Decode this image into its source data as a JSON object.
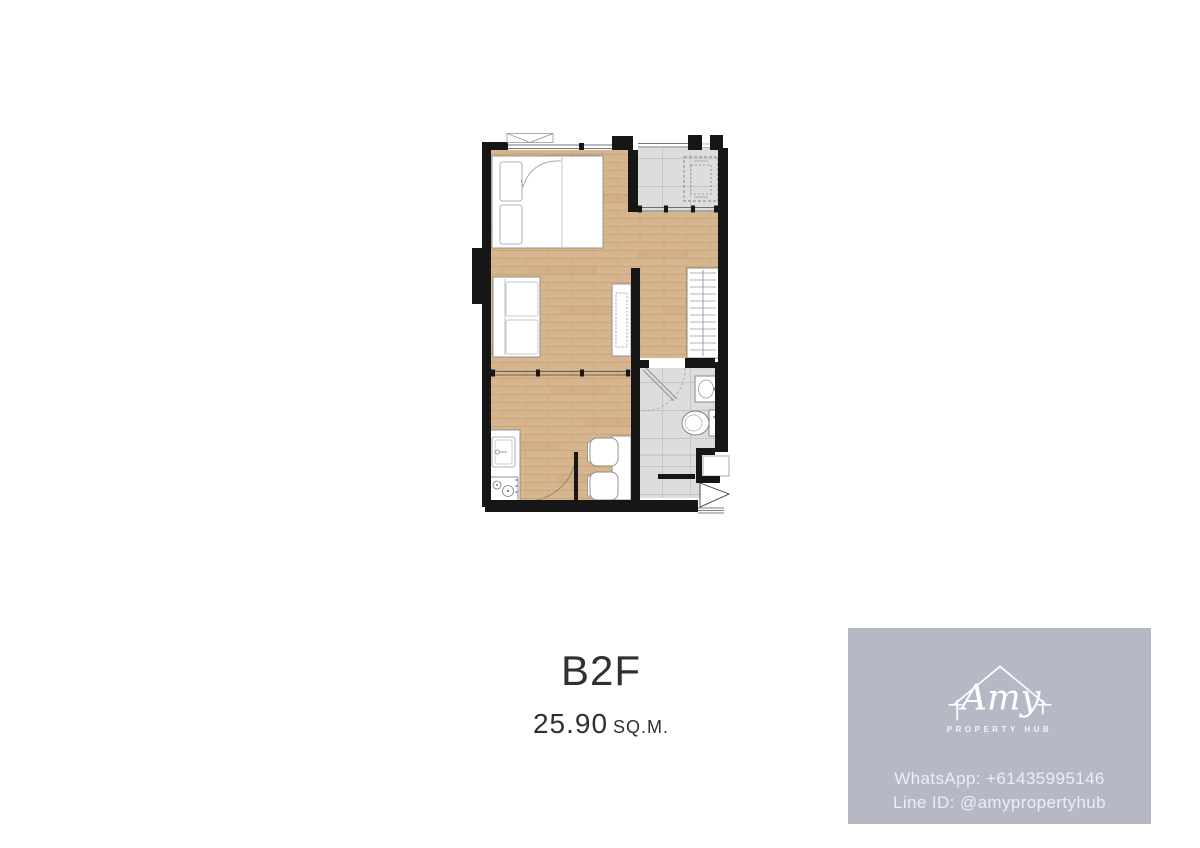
{
  "unit": {
    "name": "B2F",
    "area_value": "25.90",
    "area_unit": "SQ.M."
  },
  "watermark": {
    "logo_name": "Amy",
    "logo_subtitle": "PROPERTY HUB",
    "contact": {
      "whatsapp_label": "WhatsApp:",
      "whatsapp_value": "+61435995146",
      "line_label": "Line ID:",
      "line_value": "@amypropertyhub"
    },
    "background": "#b6b8c6",
    "text_color": "#edeff5",
    "icon": "house-outline-icon"
  },
  "plan_colors": {
    "wall": "#161616",
    "wood_floor": "#d6b58f",
    "tile_floor": "#dddddd",
    "furniture_fill": "#ffffff",
    "furniture_outline": "#8a8a8a"
  }
}
